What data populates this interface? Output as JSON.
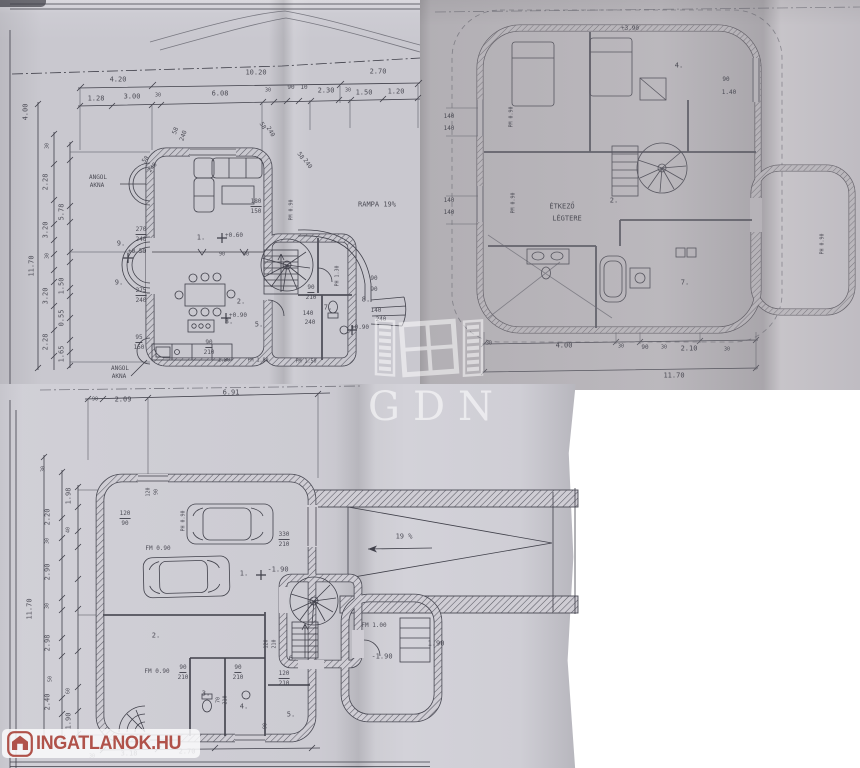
{
  "watermarks": {
    "gdn_text": "GDN",
    "logo_text": "INGATLANOK.HU"
  },
  "colors": {
    "paper_top_left": "#c9c8cf",
    "paper_top_right": "#b9b6bb",
    "paper_bottom": "#cfcdd4",
    "ink": "#40404a",
    "logo_red": "#b0524a",
    "watermark_white": "#ffffff"
  },
  "plans": {
    "ground": {
      "labels": [
        {
          "t": "4.20",
          "x": 118,
          "y": 80
        },
        {
          "t": "10.20",
          "x": 256,
          "y": 73
        },
        {
          "t": "2.70",
          "x": 378,
          "y": 72
        },
        {
          "t": "1.28",
          "x": 96,
          "y": 99
        },
        {
          "t": "3.00",
          "x": 132,
          "y": 97
        },
        {
          "t": "30",
          "x": 158,
          "y": 96,
          "s": 5
        },
        {
          "t": "6.08",
          "x": 220,
          "y": 94
        },
        {
          "t": "30",
          "x": 268,
          "y": 91,
          "s": 5
        },
        {
          "t": "90",
          "x": 291,
          "y": 88,
          "s": 6
        },
        {
          "t": "10",
          "x": 304,
          "y": 88,
          "s": 6
        },
        {
          "t": "2.30",
          "x": 326,
          "y": 91
        },
        {
          "t": "30",
          "x": 348,
          "y": 91,
          "s": 5
        },
        {
          "t": "1.50",
          "x": 364,
          "y": 93
        },
        {
          "t": "1.20",
          "x": 396,
          "y": 92
        },
        {
          "t": "4.00",
          "x": 26,
          "y": 112,
          "r": -90
        },
        {
          "t": "30",
          "x": 48,
          "y": 146,
          "r": -90,
          "s": 5
        },
        {
          "t": "2.28",
          "x": 46,
          "y": 182,
          "r": -90
        },
        {
          "t": "5.78",
          "x": 62,
          "y": 212,
          "r": -90
        },
        {
          "t": "3.20",
          "x": 46,
          "y": 230,
          "r": -90
        },
        {
          "t": "30",
          "x": 48,
          "y": 256,
          "r": -90,
          "s": 5
        },
        {
          "t": "1.50",
          "x": 62,
          "y": 286,
          "r": -90
        },
        {
          "t": "3.20",
          "x": 46,
          "y": 296,
          "r": -90
        },
        {
          "t": "0.55",
          "x": 62,
          "y": 318,
          "r": -90
        },
        {
          "t": "2.28",
          "x": 46,
          "y": 342,
          "r": -90
        },
        {
          "t": "1.65",
          "x": 62,
          "y": 354,
          "r": -90
        },
        {
          "t": "11.70",
          "x": 32,
          "y": 266,
          "r": -90
        },
        {
          "t": "ANGOL",
          "x": 98,
          "y": 178,
          "s": 6
        },
        {
          "t": "AKNA",
          "x": 97,
          "y": 186,
          "s": 6
        },
        {
          "t": "ANGOL",
          "x": 120,
          "y": 369,
          "s": 6
        },
        {
          "t": "AKNA",
          "x": 119,
          "y": 377,
          "s": 6
        },
        {
          "t": "RAMPA 19%",
          "x": 377,
          "y": 205
        },
        {
          "t": "58",
          "x": 146,
          "y": 160,
          "r": -50,
          "s": 6
        },
        {
          "t": "240",
          "x": 153,
          "y": 168,
          "r": -50,
          "s": 6
        },
        {
          "t": "58",
          "x": 176,
          "y": 131,
          "r": -70,
          "s": 6
        },
        {
          "t": "240",
          "x": 184,
          "y": 136,
          "r": -70,
          "s": 6
        },
        {
          "t": "58",
          "x": 262,
          "y": 126,
          "r": 60,
          "s": 6
        },
        {
          "t": "240",
          "x": 270,
          "y": 132,
          "r": 60,
          "s": 6
        },
        {
          "t": "58",
          "x": 300,
          "y": 156,
          "r": 55,
          "s": 6
        },
        {
          "t": "240",
          "x": 307,
          "y": 164,
          "r": 55,
          "s": 6
        },
        {
          "t": "270",
          "x": 141,
          "y": 231,
          "u": 1,
          "s": 6
        },
        {
          "t": "240",
          "x": 141,
          "y": 240,
          "s": 6
        },
        {
          "t": "1.",
          "x": 201,
          "y": 238
        },
        {
          "t": "+0.60",
          "x": 234,
          "y": 236,
          "s": 6
        },
        {
          "t": "9.",
          "x": 121,
          "y": 244
        },
        {
          "t": "+0.50",
          "x": 137,
          "y": 252,
          "s": 6
        },
        {
          "t": "9.",
          "x": 119,
          "y": 283
        },
        {
          "t": "275",
          "x": 141,
          "y": 292,
          "u": 1,
          "s": 6
        },
        {
          "t": "240",
          "x": 141,
          "y": 301,
          "s": 6
        },
        {
          "t": "180",
          "x": 256,
          "y": 203,
          "u": 1,
          "s": 6
        },
        {
          "t": "150",
          "x": 256,
          "y": 212,
          "s": 6
        },
        {
          "t": "PM 0.90",
          "x": 292,
          "y": 210,
          "r": -90,
          "s": 5
        },
        {
          "t": "2.",
          "x": 241,
          "y": 302
        },
        {
          "t": "+0.90",
          "x": 238,
          "y": 316,
          "s": 6
        },
        {
          "t": "95",
          "x": 139,
          "y": 339,
          "u": 1,
          "s": 6
        },
        {
          "t": "150",
          "x": 139,
          "y": 348,
          "s": 6
        },
        {
          "t": "90",
          "x": 209,
          "y": 344,
          "u": 1,
          "s": 6
        },
        {
          "t": "210",
          "x": 209,
          "y": 353,
          "s": 6
        },
        {
          "t": "3.",
          "x": 229,
          "y": 322
        },
        {
          "t": "5.",
          "x": 259,
          "y": 325
        },
        {
          "t": "1.80",
          "x": 224,
          "y": 361,
          "s": 5
        },
        {
          "t": "PM 1.80",
          "x": 258,
          "y": 361,
          "s": 5
        },
        {
          "t": "90",
          "x": 222,
          "y": 255,
          "s": 5
        },
        {
          "t": "90",
          "x": 246,
          "y": 255,
          "s": 5
        },
        {
          "t": "90",
          "x": 311,
          "y": 289,
          "u": 1,
          "s": 6
        },
        {
          "t": "210",
          "x": 311,
          "y": 298,
          "s": 6
        },
        {
          "t": "PH 1.30",
          "x": 338,
          "y": 276,
          "r": -90,
          "s": 5
        },
        {
          "t": "90",
          "x": 374,
          "y": 279,
          "s": 6
        },
        {
          "t": "90",
          "x": 374,
          "y": 290,
          "s": 6
        },
        {
          "t": "8.",
          "x": 366,
          "y": 300
        },
        {
          "t": "7.",
          "x": 328,
          "y": 308
        },
        {
          "t": "140",
          "x": 308,
          "y": 314,
          "s": 6
        },
        {
          "t": "240",
          "x": 310,
          "y": 323,
          "s": 6
        },
        {
          "t": "140",
          "x": 376,
          "y": 311,
          "s": 6
        },
        {
          "t": "240",
          "x": 381,
          "y": 320,
          "s": 6
        },
        {
          "t": "+0.90",
          "x": 360,
          "y": 328,
          "s": 6
        },
        {
          "t": "PM 1.50",
          "x": 306,
          "y": 362,
          "s": 5
        }
      ]
    },
    "upper": {
      "labels": [
        {
          "t": "+3.90",
          "x": 630,
          "y": 29,
          "s": 6
        },
        {
          "t": "4.",
          "x": 679,
          "y": 66
        },
        {
          "t": "90",
          "x": 726,
          "y": 80,
          "s": 6
        },
        {
          "t": "1.40",
          "x": 729,
          "y": 93,
          "s": 6
        },
        {
          "t": "140",
          "x": 449,
          "y": 117,
          "s": 6
        },
        {
          "t": "140",
          "x": 449,
          "y": 129,
          "s": 6
        },
        {
          "t": "PM 0.90",
          "x": 512,
          "y": 117,
          "r": -90,
          "s": 5
        },
        {
          "t": "140",
          "x": 449,
          "y": 201,
          "s": 6
        },
        {
          "t": "140",
          "x": 449,
          "y": 213,
          "s": 6
        },
        {
          "t": "PM 0.90",
          "x": 514,
          "y": 203,
          "r": -90,
          "s": 5
        },
        {
          "t": "ÉTKEZŐ",
          "x": 562,
          "y": 207
        },
        {
          "t": "LÉGTERE",
          "x": 567,
          "y": 219
        },
        {
          "t": "2.",
          "x": 614,
          "y": 201
        },
        {
          "t": "7.",
          "x": 685,
          "y": 283
        },
        {
          "t": "PH 0.90",
          "x": 823,
          "y": 244,
          "r": -90,
          "s": 5
        },
        {
          "t": "30",
          "x": 489,
          "y": 344,
          "s": 5
        },
        {
          "t": "4.00",
          "x": 564,
          "y": 346
        },
        {
          "t": "30",
          "x": 621,
          "y": 347,
          "s": 5
        },
        {
          "t": "90",
          "x": 645,
          "y": 348,
          "s": 6
        },
        {
          "t": "30",
          "x": 664,
          "y": 348,
          "s": 5
        },
        {
          "t": "2.10",
          "x": 689,
          "y": 349
        },
        {
          "t": "30",
          "x": 727,
          "y": 350,
          "s": 5
        },
        {
          "t": "11.70",
          "x": 674,
          "y": 376
        }
      ]
    },
    "basement": {
      "labels": [
        {
          "t": "90",
          "x": 95,
          "y": 400,
          "s": 5
        },
        {
          "t": "2.09",
          "x": 123,
          "y": 400
        },
        {
          "t": "6.91",
          "x": 231,
          "y": 393
        },
        {
          "t": "30",
          "x": 44,
          "y": 469,
          "r": -90,
          "s": 5
        },
        {
          "t": "1.98",
          "x": 69,
          "y": 496,
          "r": -90
        },
        {
          "t": "2.20",
          "x": 48,
          "y": 517,
          "r": -90
        },
        {
          "t": "40",
          "x": 69,
          "y": 530,
          "r": -90,
          "s": 5
        },
        {
          "t": "30",
          "x": 48,
          "y": 541,
          "r": -90,
          "s": 5
        },
        {
          "t": "2.90",
          "x": 48,
          "y": 572,
          "r": -90
        },
        {
          "t": "30",
          "x": 48,
          "y": 606,
          "r": -90,
          "s": 5
        },
        {
          "t": "11.70",
          "x": 30,
          "y": 609,
          "r": -90
        },
        {
          "t": "2.98",
          "x": 48,
          "y": 643,
          "r": -90
        },
        {
          "t": "50",
          "x": 51,
          "y": 679,
          "r": -90,
          "s": 5
        },
        {
          "t": "60",
          "x": 69,
          "y": 691,
          "r": -90,
          "s": 5
        },
        {
          "t": "2.40",
          "x": 48,
          "y": 702,
          "r": -90
        },
        {
          "t": "1.90",
          "x": 69,
          "y": 721,
          "r": -90
        },
        {
          "t": "120",
          "x": 125,
          "y": 515,
          "u": 1,
          "s": 6
        },
        {
          "t": "90",
          "x": 125,
          "y": 524,
          "s": 6
        },
        {
          "t": "120",
          "x": 149,
          "y": 492,
          "r": -90,
          "s": 5
        },
        {
          "t": "90",
          "x": 157,
          "y": 492,
          "r": -90,
          "s": 5
        },
        {
          "t": "PH 0.90",
          "x": 184,
          "y": 521,
          "r": -90,
          "s": 5
        },
        {
          "t": "FM 0.90",
          "x": 158,
          "y": 549,
          "s": 6
        },
        {
          "t": "330",
          "x": 284,
          "y": 536,
          "u": 1,
          "s": 6
        },
        {
          "t": "210",
          "x": 284,
          "y": 545,
          "s": 6
        },
        {
          "t": "1.",
          "x": 244,
          "y": 574
        },
        {
          "t": "-1.90",
          "x": 278,
          "y": 570
        },
        {
          "t": "19 %",
          "x": 404,
          "y": 537
        },
        {
          "t": "2.",
          "x": 156,
          "y": 636
        },
        {
          "t": "120",
          "x": 267,
          "y": 644,
          "r": -90,
          "s": 5
        },
        {
          "t": "210",
          "x": 275,
          "y": 644,
          "r": -90,
          "s": 5
        },
        {
          "t": "6.",
          "x": 293,
          "y": 659
        },
        {
          "t": "FM 1.00",
          "x": 374,
          "y": 626,
          "s": 6
        },
        {
          "t": "-1.90",
          "x": 382,
          "y": 657
        },
        {
          "t": "1.90",
          "x": 436,
          "y": 644
        },
        {
          "t": "FM 0.90",
          "x": 157,
          "y": 672,
          "s": 6
        },
        {
          "t": "90",
          "x": 183,
          "y": 669,
          "u": 1,
          "s": 6
        },
        {
          "t": "210",
          "x": 183,
          "y": 678,
          "s": 6
        },
        {
          "t": "3.",
          "x": 206,
          "y": 694
        },
        {
          "t": "4.",
          "x": 244,
          "y": 707
        },
        {
          "t": "5.",
          "x": 291,
          "y": 715
        },
        {
          "t": "90",
          "x": 238,
          "y": 669,
          "u": 1,
          "s": 6
        },
        {
          "t": "210",
          "x": 238,
          "y": 678,
          "s": 6
        },
        {
          "t": "120",
          "x": 284,
          "y": 675,
          "u": 1,
          "s": 6
        },
        {
          "t": "210",
          "x": 284,
          "y": 684,
          "s": 6
        },
        {
          "t": "70",
          "x": 219,
          "y": 700,
          "r": -90,
          "s": 5
        },
        {
          "t": "210",
          "x": 226,
          "y": 700,
          "r": -90,
          "s": 5
        },
        {
          "t": "90",
          "x": 266,
          "y": 726,
          "r": -90,
          "s": 5
        },
        {
          "t": "3.18",
          "x": 129,
          "y": 754
        },
        {
          "t": "2.70",
          "x": 187,
          "y": 752
        },
        {
          "t": "30",
          "x": 92,
          "y": 757,
          "s": 5
        }
      ]
    }
  }
}
